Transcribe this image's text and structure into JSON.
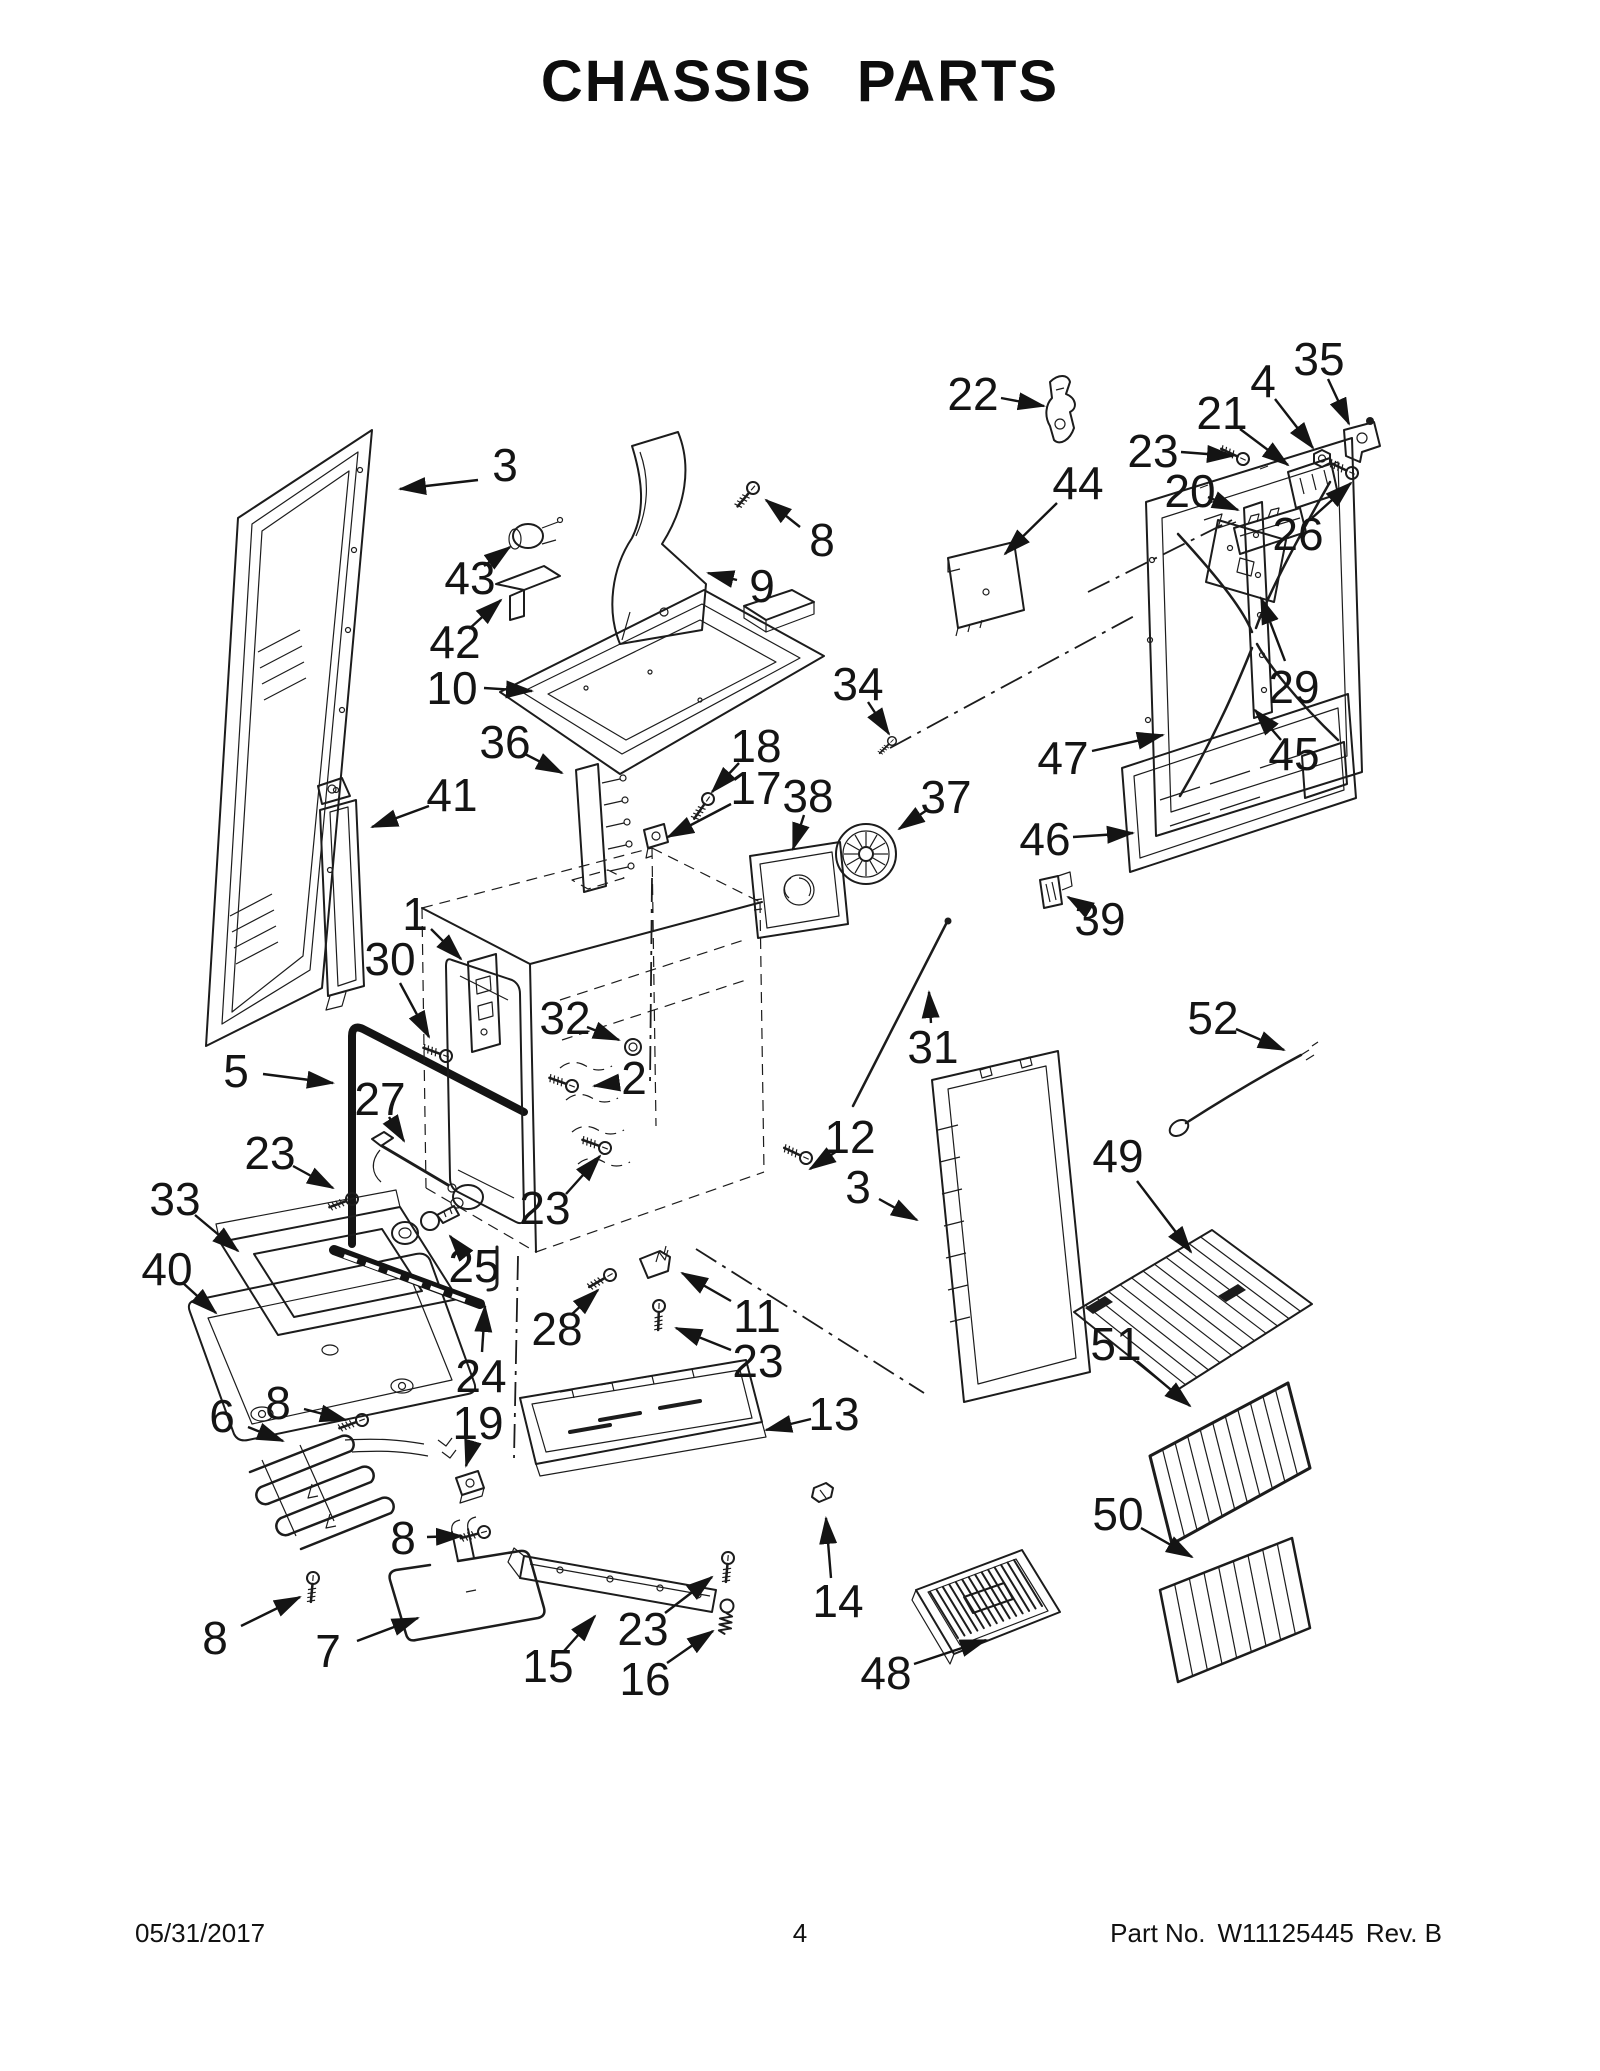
{
  "page": {
    "title": "CHASSIS PARTS",
    "footer": {
      "date": "05/31/2017",
      "page_number": "4",
      "part_label": "Part No.",
      "part_number": "W11125445",
      "revision": "Rev.  B"
    }
  },
  "diagram": {
    "width": 1600,
    "height": 2071,
    "ink_color": "#1c1c1c",
    "labels": [
      {
        "text": "3",
        "x": 505,
        "y": 465,
        "lx": 478,
        "ly": 480,
        "ax": 400,
        "ay": 489
      },
      {
        "text": "8",
        "x": 822,
        "y": 540,
        "lx": 800,
        "ly": 527,
        "ax": 766,
        "ay": 500
      },
      {
        "text": "9",
        "x": 762,
        "y": 586,
        "lx": 737,
        "ly": 580,
        "ax": 708,
        "ay": 573
      },
      {
        "text": "43",
        "x": 470,
        "y": 578,
        "lx": 484,
        "ly": 566,
        "ax": 510,
        "ay": 547
      },
      {
        "text": "42",
        "x": 455,
        "y": 642,
        "lx": 469,
        "ly": 629,
        "ax": 501,
        "ay": 600
      },
      {
        "text": "10",
        "x": 452,
        "y": 688,
        "lx": 484,
        "ly": 688,
        "ax": 532,
        "ay": 691
      },
      {
        "text": "36",
        "x": 505,
        "y": 742,
        "lx": 523,
        "ly": 753,
        "ax": 562,
        "ay": 773
      },
      {
        "text": "18",
        "x": 756,
        "y": 746,
        "lx": 739,
        "ly": 763,
        "ax": 712,
        "ay": 792
      },
      {
        "text": "17",
        "x": 756,
        "y": 788,
        "lx": 731,
        "ly": 804,
        "ax": 668,
        "ay": 837
      },
      {
        "text": "38",
        "x": 808,
        "y": 796,
        "lx": 804,
        "ly": 815,
        "ax": 793,
        "ay": 849
      },
      {
        "text": "41",
        "x": 452,
        "y": 795,
        "lx": 429,
        "ly": 806,
        "ax": 372,
        "ay": 827
      },
      {
        "text": "34",
        "x": 858,
        "y": 684,
        "lx": 868,
        "ly": 702,
        "ax": 889,
        "ay": 734
      },
      {
        "text": "37",
        "x": 946,
        "y": 797,
        "lx": 927,
        "ly": 810,
        "ax": 899,
        "ay": 829
      },
      {
        "text": "22",
        "x": 973,
        "y": 394,
        "lx": 1001,
        "ly": 398,
        "ax": 1044,
        "ay": 406
      },
      {
        "text": "44",
        "x": 1078,
        "y": 483,
        "lx": 1057,
        "ly": 503,
        "ax": 1005,
        "ay": 554
      },
      {
        "text": "23",
        "x": 1153,
        "y": 451,
        "lx": 1181,
        "ly": 452,
        "ax": 1233,
        "ay": 456
      },
      {
        "text": "21",
        "x": 1222,
        "y": 413,
        "lx": 1240,
        "ly": 429,
        "ax": 1288,
        "ay": 465
      },
      {
        "text": "4",
        "x": 1263,
        "y": 381,
        "lx": 1275,
        "ly": 399,
        "ax": 1313,
        "ay": 448
      },
      {
        "text": "35",
        "x": 1319,
        "y": 359,
        "lx": 1328,
        "ly": 379,
        "ax": 1349,
        "ay": 424
      },
      {
        "text": "26",
        "x": 1298,
        "y": 534,
        "lx": 1312,
        "ly": 518,
        "ax": 1351,
        "ay": 483
      },
      {
        "text": "20",
        "x": 1190,
        "y": 491,
        "lx": 1208,
        "ly": 497,
        "ax": 1238,
        "ay": 510
      },
      {
        "text": "29",
        "x": 1294,
        "y": 687,
        "lx": 1285,
        "ly": 661,
        "ax": 1261,
        "ay": 598
      },
      {
        "text": "45",
        "x": 1294,
        "y": 754,
        "lx": 1281,
        "ly": 740,
        "ax": 1255,
        "ay": 710
      },
      {
        "text": "47",
        "x": 1063,
        "y": 758,
        "lx": 1092,
        "ly": 751,
        "ax": 1163,
        "ay": 735
      },
      {
        "text": "46",
        "x": 1045,
        "y": 839,
        "lx": 1073,
        "ly": 837,
        "ax": 1133,
        "ay": 833
      },
      {
        "text": "39",
        "x": 1100,
        "y": 919,
        "lx": 1086,
        "ly": 908,
        "ax": 1068,
        "ay": 897
      },
      {
        "text": "1",
        "x": 415,
        "y": 914,
        "lx": 431,
        "ly": 929,
        "ax": 461,
        "ay": 959
      },
      {
        "text": "30",
        "x": 390,
        "y": 959,
        "lx": 400,
        "ly": 983,
        "ax": 429,
        "ay": 1037
      },
      {
        "text": "32",
        "x": 565,
        "y": 1018,
        "lx": 587,
        "ly": 1027,
        "ax": 619,
        "ay": 1040
      },
      {
        "text": "2",
        "x": 634,
        "y": 1078,
        "lx": 616,
        "ly": 1083,
        "ax": 594,
        "ay": 1086
      },
      {
        "text": "5",
        "x": 236,
        "y": 1071,
        "lx": 263,
        "ly": 1074,
        "ax": 333,
        "ay": 1083
      },
      {
        "text": "27",
        "x": 380,
        "y": 1099,
        "lx": 389,
        "ly": 1117,
        "ax": 404,
        "ay": 1141
      },
      {
        "text": "23",
        "x": 270,
        "y": 1153,
        "lx": 293,
        "ly": 1166,
        "ax": 333,
        "ay": 1188
      },
      {
        "text": "33",
        "x": 175,
        "y": 1199,
        "lx": 195,
        "ly": 1215,
        "ax": 238,
        "ay": 1251
      },
      {
        "text": "40",
        "x": 167,
        "y": 1269,
        "lx": 183,
        "ly": 1283,
        "ax": 216,
        "ay": 1313
      },
      {
        "text": "25",
        "x": 474,
        "y": 1266,
        "lx": 463,
        "ly": 1252,
        "ax": 450,
        "ay": 1236
      },
      {
        "text": "24",
        "x": 481,
        "y": 1376,
        "lx": 482,
        "ly": 1352,
        "ax": 485,
        "ay": 1306
      },
      {
        "text": "19",
        "x": 478,
        "y": 1423,
        "lx": 473,
        "ly": 1441,
        "ax": 466,
        "ay": 1466
      },
      {
        "text": "28",
        "x": 557,
        "y": 1329,
        "lx": 571,
        "ly": 1315,
        "ax": 598,
        "ay": 1290
      },
      {
        "text": "11",
        "x": 757,
        "y": 1316,
        "lx": 731,
        "ly": 1301,
        "ax": 682,
        "ay": 1273
      },
      {
        "text": "23",
        "x": 758,
        "y": 1361,
        "lx": 731,
        "ly": 1350,
        "ax": 676,
        "ay": 1328
      },
      {
        "text": "23",
        "x": 545,
        "y": 1208,
        "lx": 566,
        "ly": 1194,
        "ax": 600,
        "ay": 1156
      },
      {
        "text": "31",
        "x": 933,
        "y": 1047,
        "lx": 931,
        "ly": 1023,
        "ax": 929,
        "ay": 992
      },
      {
        "text": "52",
        "x": 1213,
        "y": 1018,
        "lx": 1236,
        "ly": 1029,
        "ax": 1284,
        "ay": 1050
      },
      {
        "text": "12",
        "x": 850,
        "y": 1137,
        "lx": 837,
        "ly": 1151,
        "ax": 810,
        "ay": 1169
      },
      {
        "text": "3",
        "x": 858,
        "y": 1187,
        "lx": 879,
        "ly": 1199,
        "ax": 917,
        "ay": 1220
      },
      {
        "text": "49",
        "x": 1118,
        "y": 1156,
        "lx": 1137,
        "ly": 1181,
        "ax": 1191,
        "ay": 1252
      },
      {
        "text": "13",
        "x": 834,
        "y": 1414,
        "lx": 811,
        "ly": 1419,
        "ax": 766,
        "ay": 1430
      },
      {
        "text": "6",
        "x": 222,
        "y": 1416,
        "lx": 248,
        "ly": 1427,
        "ax": 283,
        "ay": 1441
      },
      {
        "text": "8",
        "x": 278,
        "y": 1403,
        "lx": 304,
        "ly": 1409,
        "ax": 346,
        "ay": 1420
      },
      {
        "text": "8",
        "x": 403,
        "y": 1538,
        "lx": 427,
        "ly": 1537,
        "ax": 462,
        "ay": 1536
      },
      {
        "text": "8",
        "x": 215,
        "y": 1638,
        "lx": 241,
        "ly": 1626,
        "ax": 300,
        "ay": 1597
      },
      {
        "text": "7",
        "x": 328,
        "y": 1651,
        "lx": 357,
        "ly": 1641,
        "ax": 418,
        "ay": 1618
      },
      {
        "text": "15",
        "x": 548,
        "y": 1666,
        "lx": 564,
        "ly": 1651,
        "ax": 595,
        "ay": 1616
      },
      {
        "text": "23",
        "x": 643,
        "y": 1629,
        "lx": 665,
        "ly": 1613,
        "ax": 712,
        "ay": 1577
      },
      {
        "text": "16",
        "x": 645,
        "y": 1679,
        "lx": 667,
        "ly": 1663,
        "ax": 713,
        "ay": 1631
      },
      {
        "text": "14",
        "x": 838,
        "y": 1601,
        "lx": 831,
        "ly": 1578,
        "ax": 826,
        "ay": 1518
      },
      {
        "text": "48",
        "x": 886,
        "y": 1673,
        "lx": 914,
        "ly": 1664,
        "ax": 986,
        "ay": 1640
      },
      {
        "text": "51",
        "x": 1116,
        "y": 1344,
        "lx": 1137,
        "ly": 1361,
        "ax": 1190,
        "ay": 1406
      },
      {
        "text": "50",
        "x": 1118,
        "y": 1514,
        "lx": 1141,
        "ly": 1528,
        "ax": 1192,
        "ay": 1557
      }
    ]
  }
}
